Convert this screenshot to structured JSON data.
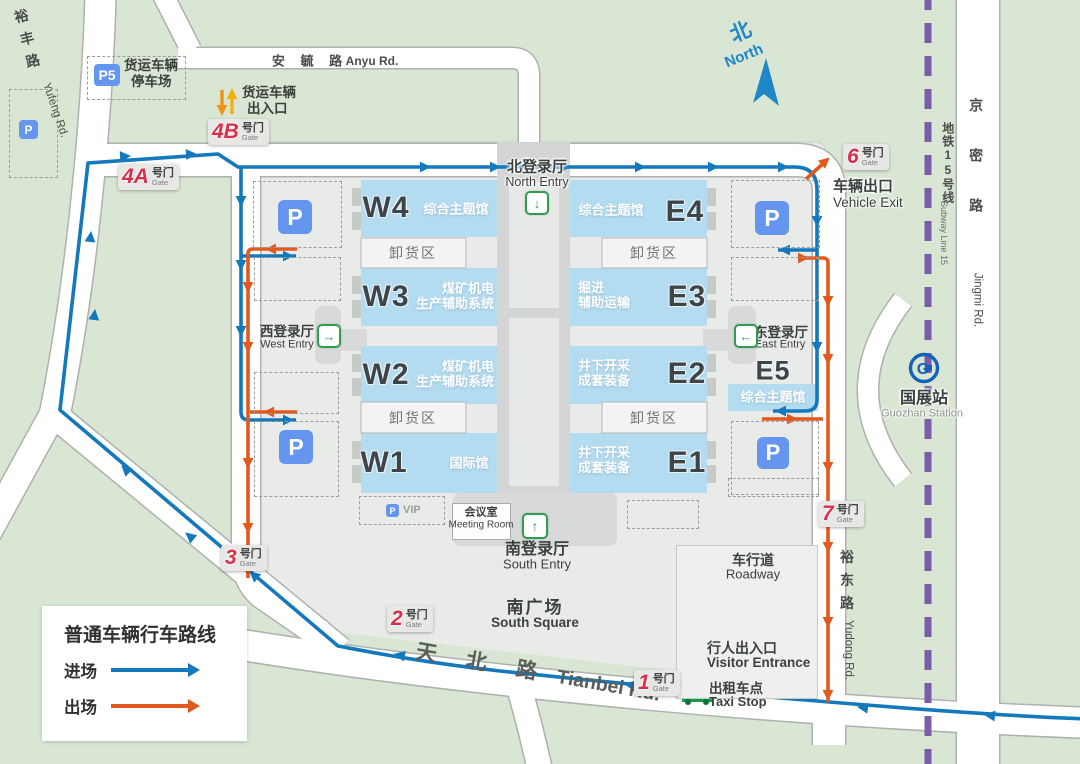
{
  "legend": {
    "title": "普通车辆行车路线",
    "enter": "进场",
    "exit": "出场"
  },
  "compass": {
    "cn": "北",
    "en": "North"
  },
  "roads": {
    "anyu_cn": "安 毓 路",
    "anyu_en": "Anyu Rd.",
    "yufeng_cn": "裕丰路",
    "yufeng_en": "Yufeng Rd.",
    "tianbei_cn": "天 北 路",
    "tianbei_en": "Tianbei Rd.",
    "yudong_cn": "裕东路",
    "yudong_en": "Yudong Rd.",
    "jingmi_cn": "京密路",
    "jingmi_en": "Jingmi Rd.",
    "subway_cn": "地铁15号线",
    "subway_en": "Subway Line 15"
  },
  "station": {
    "cn": "国展站",
    "en": "Guozhan Station",
    "logo": "G"
  },
  "entries": {
    "north_cn": "北登录厅",
    "north_en": "North Entry",
    "south_cn": "南登录厅",
    "south_en": "South Entry",
    "west_cn": "西登录厅",
    "west_en": "West Entry",
    "east_cn": "东登录厅",
    "east_en": "East Entry"
  },
  "halls": {
    "w4_code": "W4",
    "w4_desc": "综合主题馆",
    "w3_code": "W3",
    "w3_desc1": "煤矿机电",
    "w3_desc2": "生产辅助系统",
    "w2_code": "W2",
    "w2_desc1": "煤矿机电",
    "w2_desc2": "生产辅助系统",
    "w1_code": "W1",
    "w1_desc": "国际馆",
    "e4_code": "E4",
    "e4_desc": "综合主题馆",
    "e3_code": "E3",
    "e3_desc1": "掘进",
    "e3_desc2": "辅助运输",
    "e2_code": "E2",
    "e2_desc1": "井下开采",
    "e2_desc2": "成套装备",
    "e1_code": "E1",
    "e1_desc1": "井下开采",
    "e1_desc2": "成套装备",
    "e5_code": "E5",
    "e5_desc": "综合主题馆",
    "unload": "卸货区"
  },
  "gates": {
    "suffix_cn": "号门",
    "suffix_en": "Gate",
    "g1": "1",
    "g2": "2",
    "g3": "3",
    "g4a": "4A",
    "g4b": "4B",
    "g6": "6",
    "g7": "7"
  },
  "facilities": {
    "p": "P",
    "p5": "P5",
    "vip": "VIP",
    "freight_parking_1": "货运车辆",
    "freight_parking_2": "停车场",
    "freight_gate_1": "货运车辆",
    "freight_gate_2": "出入口",
    "vehicle_exit_cn": "车辆出口",
    "vehicle_exit_en": "Vehicle Exit",
    "visitor_cn": "行人出入口",
    "visitor_en": "Visitor Entrance",
    "taxi_cn": "出租车点",
    "taxi_en": "Taxi Stop",
    "roadway_cn": "车行道",
    "roadway_en": "Roadway",
    "square_cn": "南广场",
    "square_en": "South Square",
    "meeting_cn": "会议室",
    "meeting_en": "Meeting Room"
  },
  "colors": {
    "route_enter": "#1478bc",
    "route_exit": "#e3581c",
    "subway": "#7a5ca8",
    "gate_red": "#d7304b",
    "parking_blue": "#6496f0",
    "entry_green": "#2f9e4e"
  }
}
